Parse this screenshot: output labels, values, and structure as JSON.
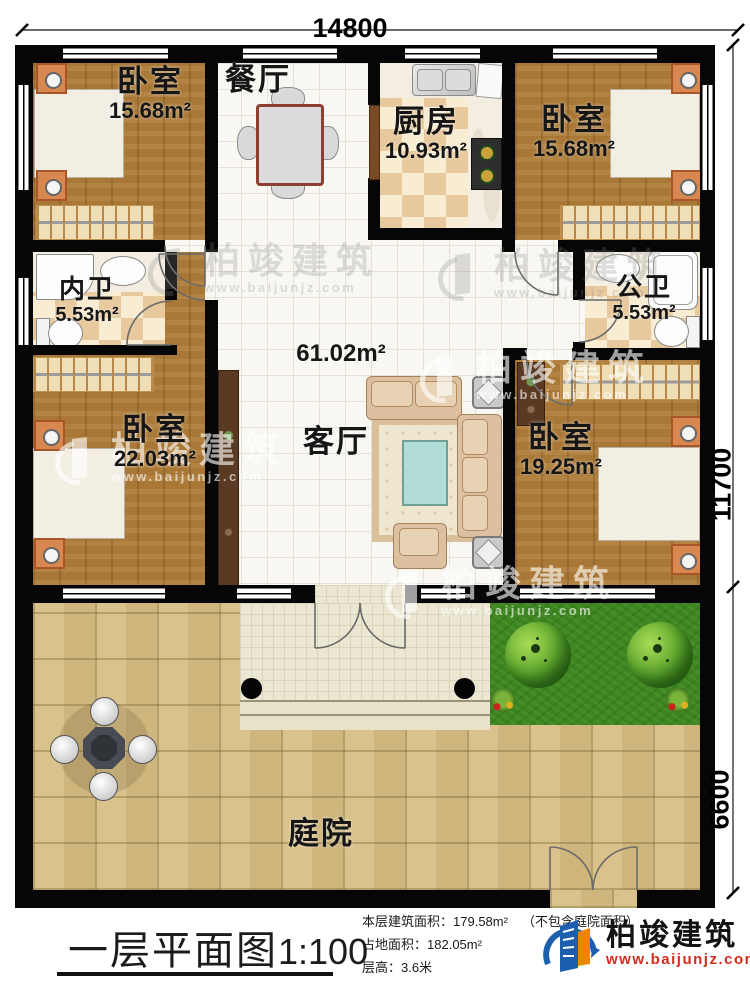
{
  "dimensions": {
    "width": "14800",
    "depth_house": "11700",
    "depth_yard": "6600"
  },
  "rooms": {
    "bedroom_tl": {
      "name": "卧室",
      "area": "15.68m²"
    },
    "dining": {
      "name": "餐厅"
    },
    "kitchen": {
      "name": "厨房",
      "area": "10.93m²"
    },
    "bedroom_tr": {
      "name": "卧室",
      "area": "15.68m²"
    },
    "bath_inner": {
      "name": "内卫",
      "area": "5.53m²"
    },
    "bath_public": {
      "name": "公卫",
      "area": "5.53m²"
    },
    "hall": {
      "name": "客厅",
      "area": "61.02m²"
    },
    "bedroom_bl": {
      "name": "卧室",
      "area": "22.03m²"
    },
    "bedroom_br": {
      "name": "卧室",
      "area": "19.25m²"
    },
    "courtyard": {
      "name": "庭院"
    }
  },
  "footer": {
    "title_main": "一层平面图",
    "title_scale": "1:100",
    "stats": [
      {
        "label": "本层建筑面积：",
        "value": "179.58m²",
        "note": "（不包含庭院面积）"
      },
      {
        "label": "占地面积：",
        "value": "182.05m²",
        "note": ""
      },
      {
        "label": "层高：",
        "value": "3.6米",
        "note": ""
      }
    ]
  },
  "brand": {
    "name": "柏竣建筑",
    "site": "www.baijunjz.com"
  },
  "watermark": {
    "name": "柏竣建筑",
    "site": "www.baijunjz.com"
  }
}
